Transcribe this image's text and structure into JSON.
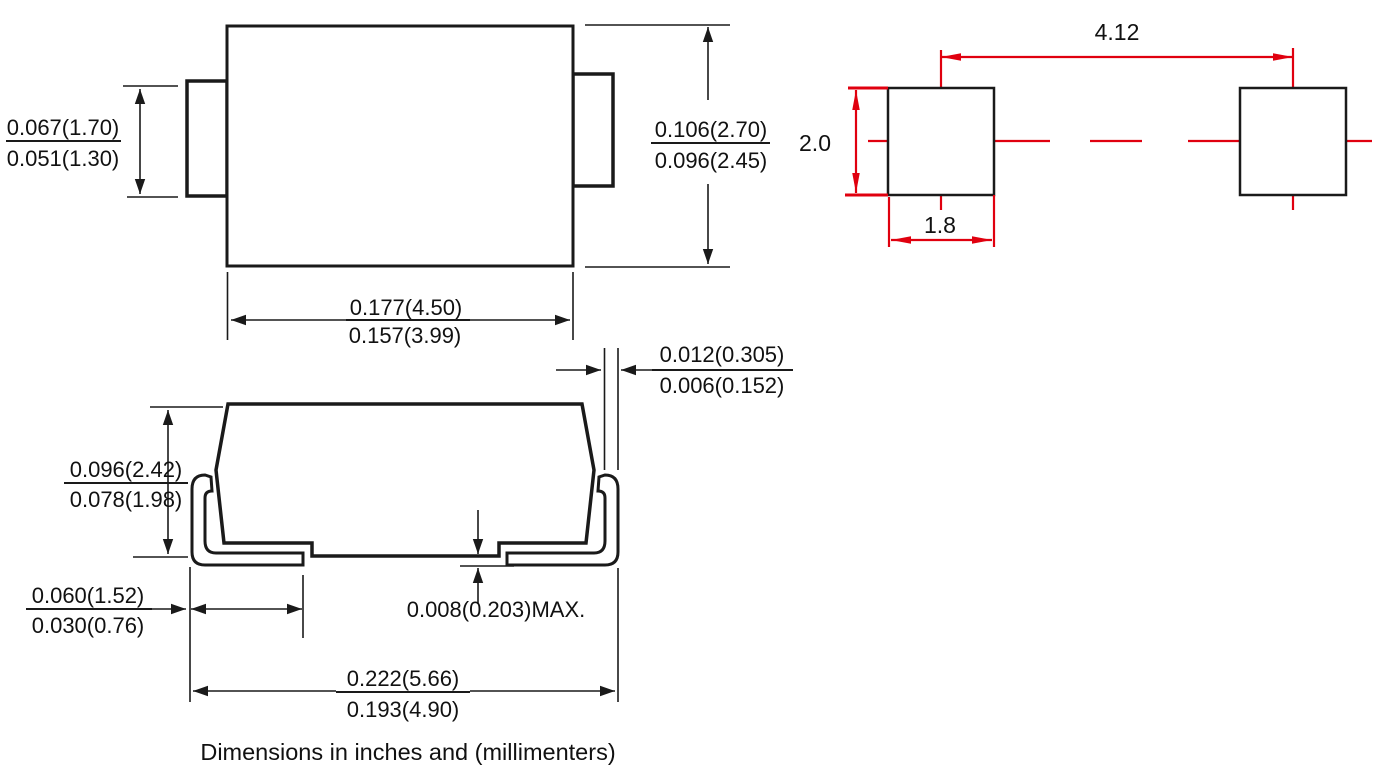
{
  "colors": {
    "line": "#1a1a1a",
    "red": "#e0000f"
  },
  "caption": "Dimensions in inches and  (millimenters)",
  "top_view": {
    "lead_width_max": "0.067(1.70)",
    "lead_width_min": "0.051(1.30)",
    "body_height_max": "0.106(2.70)",
    "body_height_min": "0.096(2.45)",
    "body_width_max": "0.177(4.50)",
    "body_width_min": "0.157(3.99)"
  },
  "side_view": {
    "body_height_max": "0.096(2.42)",
    "body_height_min": "0.078(1.98)",
    "terminal_length_max": "0.060(1.52)",
    "terminal_length_min": "0.030(0.76)",
    "standoff": "0.008(0.203)MAX.",
    "lead_thickness_max": "0.012(0.305)",
    "lead_thickness_min": "0.006(0.152)",
    "overall_length_max": "0.222(5.66)",
    "overall_length_min": "0.193(4.90)"
  },
  "land_pattern": {
    "pad_pitch": "4.12",
    "pad_height": "2.0",
    "pad_width": "1.8"
  }
}
